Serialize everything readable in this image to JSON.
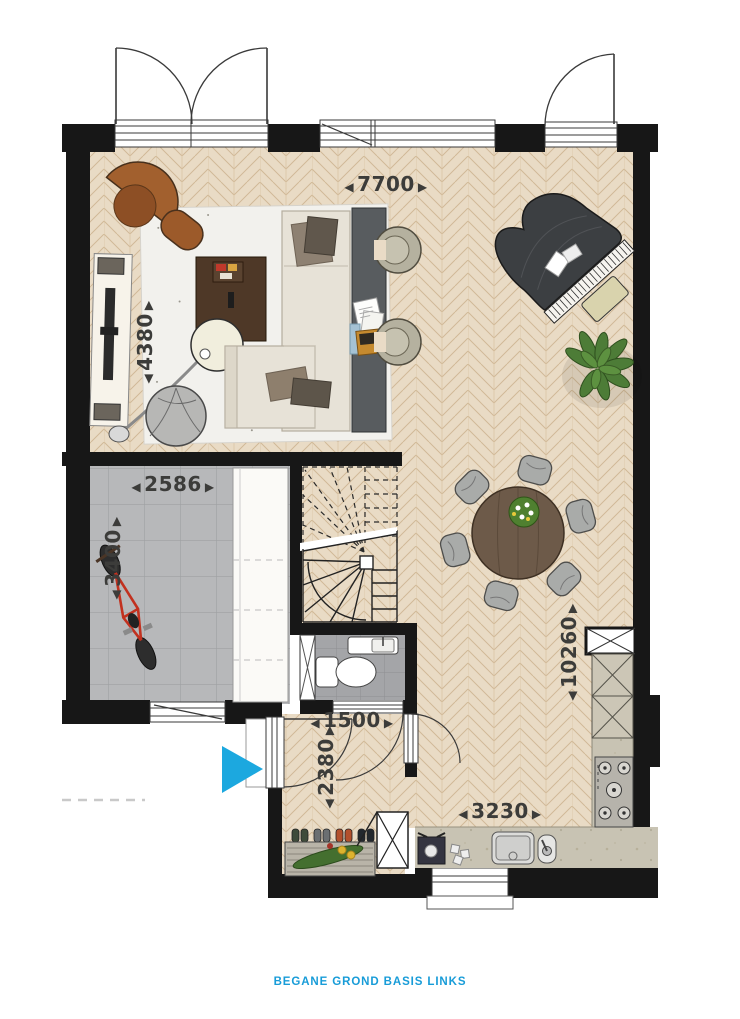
{
  "plan_caption": {
    "text": "BEGANE GROND BASIS LINKS",
    "color": "#189CD8"
  },
  "dimensions": {
    "arrow_left": "◀",
    "arrow_right": "▶",
    "living_room_width": "7700",
    "living_room_depth": "4380",
    "storage_width": "2586",
    "storage_depth": "3400",
    "house_depth": "10260",
    "hall_width": "1500",
    "hall_depth": "2380",
    "kitchen_width": "3230"
  },
  "entrance_marker": {
    "shape": "triangle-right",
    "color": "#1CA8DF"
  },
  "colors": {
    "walls": "#171717",
    "wood_floor": "#e9dbc5",
    "storage_floor": "#b7b8ba",
    "toilet_floor": "#a4a5a8",
    "counter": "#c8c3b3",
    "dimension_text": "#3c3c3a",
    "accent": "#1CA8DF"
  },
  "furniture": [
    "sofa",
    "lounge-chair",
    "ottoman",
    "coffee-table",
    "arc-lamp",
    "pouf",
    "tv-sideboard",
    "console-table",
    "tub-chair",
    "grand-piano",
    "piano-bench",
    "plant",
    "dining-table",
    "dining-chair",
    "bicycle",
    "storage-cabinet",
    "toilet",
    "washbasin",
    "meter-cupboard",
    "coat-rack",
    "wardrobe",
    "kitchen-counter",
    "sink",
    "faucet",
    "gas-hob",
    "tall-cabinet",
    "coffee-machine",
    "stairs"
  ]
}
